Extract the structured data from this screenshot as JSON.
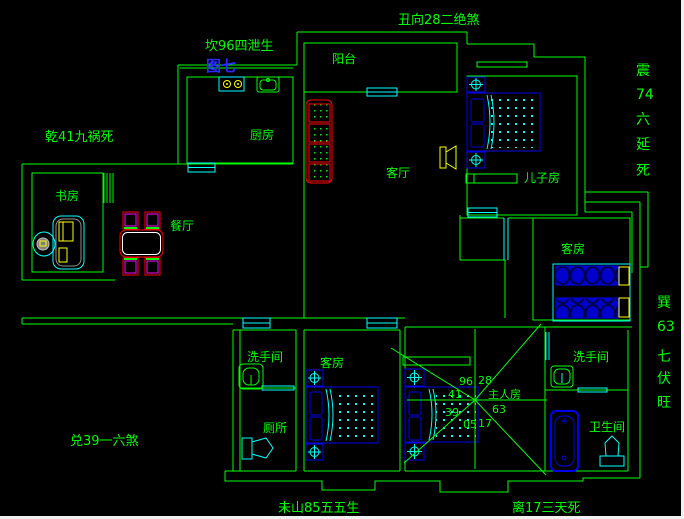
{
  "colors": {
    "background": "#000000",
    "wall_green": "#00ff00",
    "fixture_cyan": "#00ffff",
    "furniture_blue": "#0000ee",
    "accent_red": "#ff0000",
    "accent_magenta": "#ff00ff",
    "accent_yellow": "#ffff00",
    "figure_label_blue": "#2a2aff",
    "window_edge_white": "#f0f0f0"
  },
  "annotations": {
    "figure_label": "图七",
    "top": "丑向28二绝煞",
    "north": "坎96四泄生",
    "northwest": "乾41九祸死",
    "west": "兑39一六煞",
    "east_column": [
      "震",
      "74",
      "六",
      "延",
      "死"
    ],
    "southeast_column": [
      "巽",
      "63",
      "七",
      "伏",
      "旺"
    ],
    "bottom_left": "未山85五五生",
    "bottom_right": "离17三天死"
  },
  "rooms": {
    "balcony": "阳台",
    "kitchen": "厨房",
    "living_room": "客厅",
    "son_room": "儿子房",
    "dining": "餐厅",
    "study": "书房",
    "guest_room_east": "客房",
    "washroom_sw": "洗手间",
    "toilet_sw": "厕所",
    "guest_room_south": "客房",
    "washroom_se": "洗手间",
    "bathroom_se": "卫生间"
  },
  "master_chart": {
    "room_label": "主人房",
    "sector_numbers": {
      "n_left": "96",
      "n_right": "28",
      "w_upper": "41",
      "w_lower": "39",
      "s_left": "05",
      "s_right": "17",
      "e": "63"
    }
  },
  "symbols": [
    "double-bed",
    "single-bed",
    "nightstand",
    "dresser",
    "sofa",
    "tv",
    "dining-table",
    "dining-chair",
    "desk",
    "desk-chair",
    "stove",
    "kitchen-sink",
    "wash-basin",
    "toilet",
    "bathtub",
    "window",
    "door",
    "radial-sector-lines"
  ]
}
